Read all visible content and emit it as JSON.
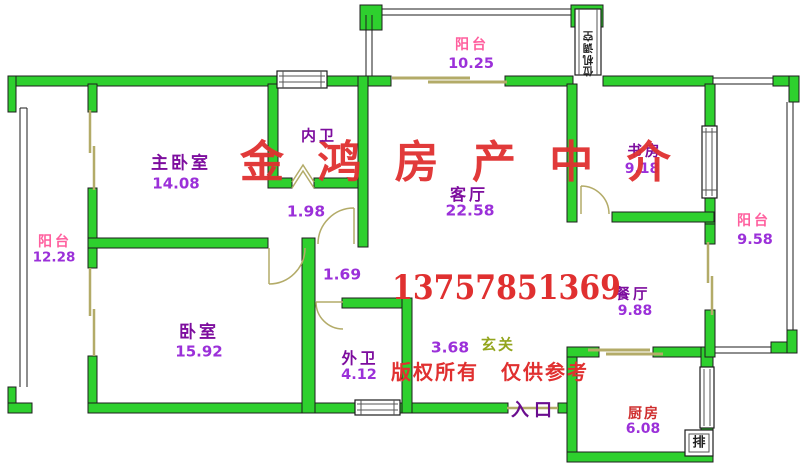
{
  "plan": {
    "watermark": {
      "brand": "金 鸿 房 产 中 介",
      "phone": "13757851369",
      "notice": "版权所有　仅供参考"
    },
    "rooms": {
      "master_bedroom": {
        "label": "主卧室",
        "area": "14.08"
      },
      "balcony_left": {
        "label": "阳台",
        "area": "12.28"
      },
      "bedroom": {
        "label": "卧室",
        "area": "15.92"
      },
      "inner_bathroom": {
        "label": "内卫",
        "area": "1.98"
      },
      "living_room": {
        "label": "客厅",
        "area": "22.58"
      },
      "hallway": {
        "area": "1.69"
      },
      "outer_bathroom": {
        "label": "外卫",
        "area": "4.12"
      },
      "foyer": {
        "label": "玄关",
        "area": "3.68"
      },
      "balcony_top": {
        "label": "阳台",
        "area": "10.25"
      },
      "study": {
        "label": "书房",
        "area": "9.18"
      },
      "balcony_right": {
        "label": "阳台",
        "area": "9.58"
      },
      "dining_room": {
        "label": "餐厅",
        "area": "9.88"
      },
      "kitchen": {
        "label": "厨房",
        "area": "6.08"
      }
    },
    "annotations": {
      "entrance": "入口",
      "exhaust": "排",
      "ac_shaft_chars": [
        "空",
        "调",
        "机",
        "位"
      ]
    },
    "colors": {
      "wall": "#2ed02e",
      "room_label": "#7d0d9e",
      "area_number": "#9b30d9",
      "balcony_label": "#ff5f9e",
      "kitchen_label": "#cf2e2e",
      "foyer_label": "#93a51d",
      "entrance_label": "#6a0d8f",
      "watermark": "#e03030",
      "window_tint": "#b3ab68"
    }
  }
}
